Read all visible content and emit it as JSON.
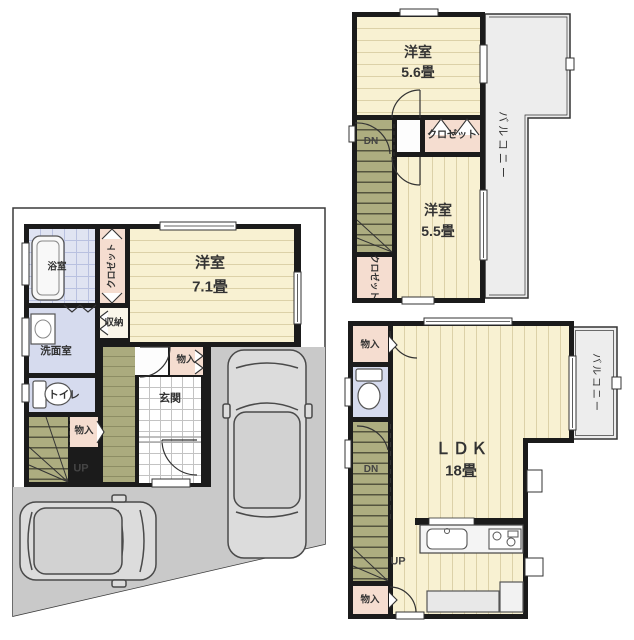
{
  "colors": {
    "wall": "#1b1b1b",
    "flooring": "#f8f1d2",
    "flooring_line": "#dcd1a8",
    "closet_pink": "#f5ddd0",
    "water_blue": "#d6dbee",
    "bath_grid": "#b9c1e0",
    "stairs_olive": "#adad80",
    "stair_tread": "#54543e",
    "hall_olive": "#abab7e",
    "parking_gray": "#c9c9c9",
    "balcony_gray": "#ededed",
    "text": "#333333"
  },
  "f3": {
    "room_a": {
      "name": "洋室",
      "size": "5.6畳"
    },
    "closet_top": "クロゼット",
    "room_b": {
      "name": "洋室",
      "size": "5.5畳"
    },
    "closet_side": "クロゼット",
    "stairs_dn": "DN",
    "balcony": "バルコニー"
  },
  "f1": {
    "bath": "浴室",
    "closet": "クロゼット",
    "room": {
      "name": "洋室",
      "size": "7.1畳"
    },
    "storage": "収納",
    "washroom": "洗面室",
    "toilet": "トイレ",
    "storage_stairs": "物入",
    "stairs_up": "UP",
    "storage_entrance": "物入",
    "entrance": "玄関"
  },
  "f2": {
    "storage_top": "物入",
    "stairs_dn": "DN",
    "stairs_up": "UP",
    "storage_bottom": "物入",
    "ldk": {
      "name": "ＬＤＫ",
      "size": "18畳"
    },
    "balcony": "バルコニー"
  }
}
